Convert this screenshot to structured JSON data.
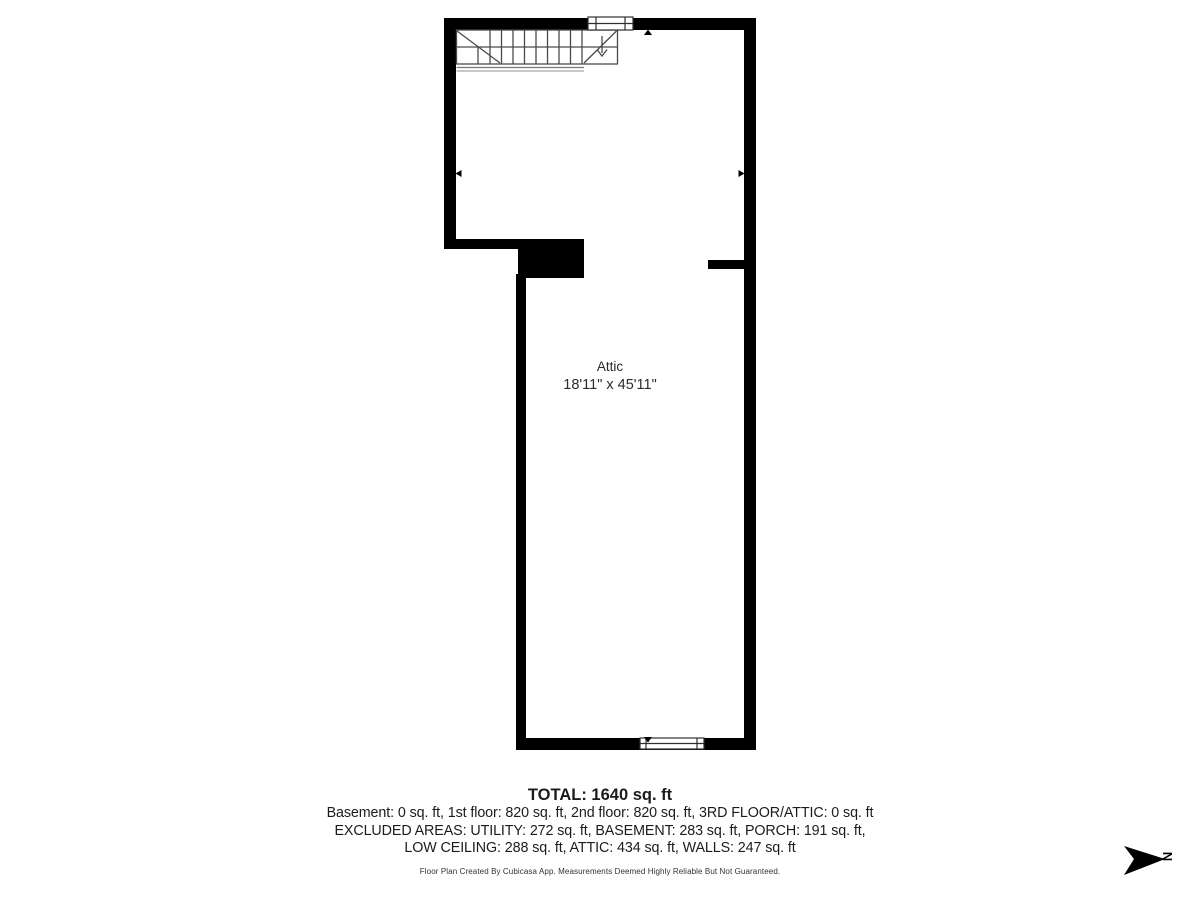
{
  "plan": {
    "room_label": "Attic",
    "room_dimensions": "18'11\" x 45'11\""
  },
  "summary": {
    "total": "TOTAL: 1640 sq. ft",
    "floors": "Basement: 0 sq. ft, 1st floor: 820 sq. ft, 2nd floor: 820 sq. ft, 3RD FLOOR/ATTIC: 0 sq. ft",
    "excluded_line1": "EXCLUDED AREAS: UTILITY: 272 sq. ft, BASEMENT: 283 sq. ft, PORCH: 191 sq. ft,",
    "excluded_line2": "LOW CEILING: 288 sq. ft, ATTIC: 434 sq. ft, WALLS: 247 sq. ft"
  },
  "footer": {
    "disclaimer": "Floor Plan Created By Cubicasa App. Measurements Deemed Highly Reliable But Not Guaranteed."
  },
  "compass": {
    "label": "N"
  },
  "colors": {
    "walls": "#000000",
    "stair_lines": "#4a4a4a",
    "landing_gray": "#a8a8a8",
    "text": "#1c1c1c"
  }
}
